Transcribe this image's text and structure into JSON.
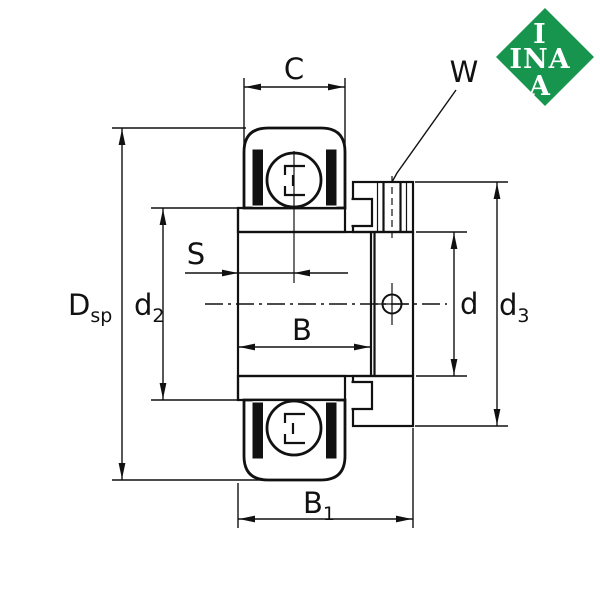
{
  "logo": {
    "top": "I",
    "middle": "INA",
    "bottom": "A",
    "color": "#17954E"
  },
  "dimensions": {
    "C": "C",
    "W": "W",
    "S": "S",
    "B": "B",
    "d": "d",
    "B1": {
      "base": "B",
      "sub": "1"
    },
    "Dsp": {
      "base": "D",
      "sub": "sp"
    },
    "d2": {
      "base": "d",
      "sub": "2"
    },
    "d3": {
      "base": "d",
      "sub": "3"
    }
  },
  "colors": {
    "line": "#111111",
    "background": "#ffffff"
  }
}
